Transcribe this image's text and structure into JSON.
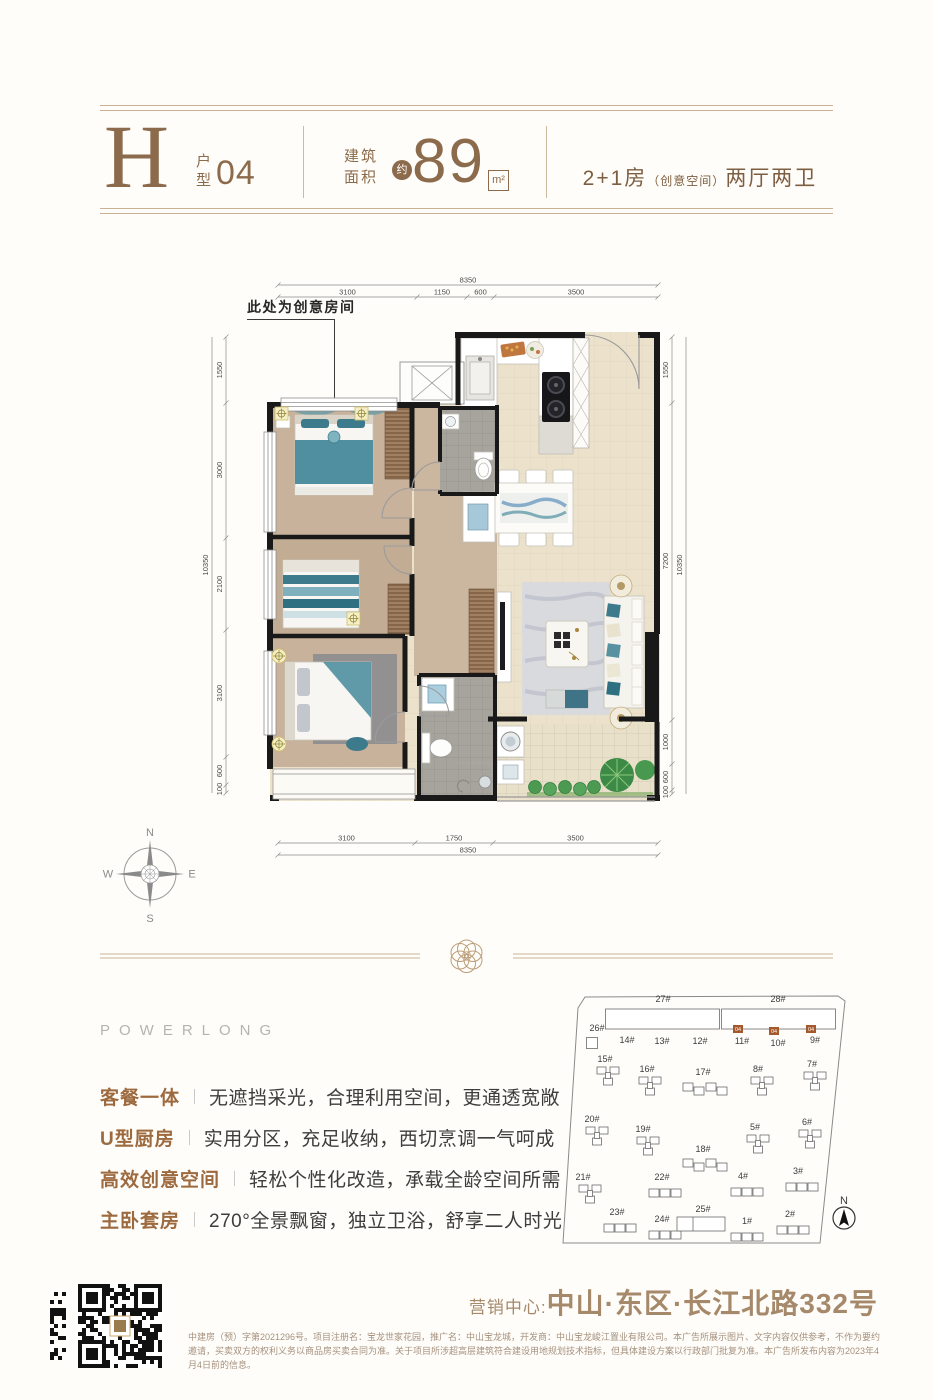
{
  "header": {
    "type_letter": "H",
    "type_stack_top": "户",
    "type_stack_bottom": "型",
    "type_number": "04",
    "area_label_top": "建筑",
    "area_label_bottom": "面积",
    "area_approx": "约",
    "area_value": "89",
    "area_unit": "m²",
    "layout_left": "2+1房",
    "layout_paren": "（创意空间）",
    "layout_right": "两厅两卫"
  },
  "floorplan": {
    "annotation": "此处为创意房间",
    "dims_top": [
      "3100",
      "1150",
      "600",
      "3500"
    ],
    "dims_top_total": "8350",
    "dims_bottom": [
      "3100",
      "1750",
      "3500"
    ],
    "dims_bottom_total": "8350",
    "dims_left": [
      "1550",
      "3000",
      "2100",
      "3100",
      "600",
      "100"
    ],
    "dims_left_total": "10350",
    "dims_right": [
      "1550",
      "7200",
      "1000",
      "600",
      "100"
    ],
    "dims_right_total": "10350",
    "compass": {
      "n": "N",
      "e": "E",
      "s": "S",
      "w": "W"
    }
  },
  "brand": "POWERLONG",
  "features": [
    {
      "label": "客餐一体",
      "desc": "无遮挡采光，合理利用空间，更通透宽敞"
    },
    {
      "label": "U型厨房",
      "desc": "实用分区，充足收纳，西切烹调一气呵成"
    },
    {
      "label": "高效创意空间",
      "desc": "轻松个性化改造，承载全龄空间所需"
    },
    {
      "label": "主卧套房",
      "desc": "270°全景飘窗，独立卫浴，舒享二人时光"
    }
  ],
  "siteplan": {
    "north": "N",
    "highlight_unit": "04",
    "highlights": [
      {
        "x": 188,
        "y": 40
      },
      {
        "x": 224,
        "y": 42
      },
      {
        "x": 261,
        "y": 40
      }
    ],
    "buildings": [
      {
        "label": "27#",
        "t": "bar",
        "lx": 118,
        "ly": 17,
        "gx": 117.5,
        "gy": 34
      },
      {
        "label": "28#",
        "t": "bar",
        "lx": 233,
        "ly": 17,
        "gx": 233.5,
        "gy": 34
      },
      {
        "label": "26#",
        "t": "sq",
        "lx": 52,
        "ly": 46,
        "gx": 47,
        "gy": 58
      },
      {
        "label": "14#",
        "t": "lbl",
        "lx": 82,
        "ly": 58
      },
      {
        "label": "13#",
        "t": "lbl",
        "lx": 117,
        "ly": 59
      },
      {
        "label": "12#",
        "t": "lbl",
        "lx": 155,
        "ly": 59
      },
      {
        "label": "11#",
        "t": "lbl",
        "lx": 197,
        "ly": 59
      },
      {
        "label": "10#",
        "t": "lbl",
        "lx": 233,
        "ly": 61
      },
      {
        "label": "9#",
        "t": "lbl",
        "lx": 270,
        "ly": 58
      },
      {
        "label": "15#",
        "t": "tri",
        "lx": 60,
        "ly": 77,
        "gx": 63,
        "gy": 92
      },
      {
        "label": "16#",
        "t": "tri",
        "lx": 102,
        "ly": 87,
        "gx": 105,
        "gy": 102
      },
      {
        "label": "17#",
        "t": "wide",
        "lx": 158,
        "ly": 90,
        "gx": 160,
        "gy": 104
      },
      {
        "label": "8#",
        "t": "tri",
        "lx": 213,
        "ly": 87,
        "gx": 217,
        "gy": 102
      },
      {
        "label": "7#",
        "t": "tri",
        "lx": 267,
        "ly": 82,
        "gx": 270,
        "gy": 97
      },
      {
        "label": "20#",
        "t": "tri",
        "lx": 47,
        "ly": 137,
        "gx": 52,
        "gy": 152
      },
      {
        "label": "19#",
        "t": "tri",
        "lx": 98,
        "ly": 147,
        "gx": 103,
        "gy": 162
      },
      {
        "label": "18#",
        "t": "wide",
        "lx": 158,
        "ly": 167,
        "gx": 160,
        "gy": 180
      },
      {
        "label": "5#",
        "t": "tri",
        "lx": 210,
        "ly": 145,
        "gx": 213,
        "gy": 160
      },
      {
        "label": "6#",
        "t": "tri",
        "lx": 262,
        "ly": 140,
        "gx": 265,
        "gy": 155
      },
      {
        "label": "21#",
        "t": "tri",
        "lx": 38,
        "ly": 195,
        "gx": 45,
        "gy": 210
      },
      {
        "label": "22#",
        "t": "row",
        "lx": 117,
        "ly": 195,
        "gx": 120,
        "gy": 208
      },
      {
        "label": "4#",
        "t": "row",
        "lx": 198,
        "ly": 194,
        "gx": 202,
        "gy": 207
      },
      {
        "label": "3#",
        "t": "row",
        "lx": 253,
        "ly": 189,
        "gx": 257,
        "gy": 202
      },
      {
        "label": "23#",
        "t": "row",
        "lx": 72,
        "ly": 230,
        "gx": 75,
        "gy": 243
      },
      {
        "label": "24#",
        "t": "row",
        "lx": 117,
        "ly": 237,
        "gx": 120,
        "gy": 250
      },
      {
        "label": "25#",
        "t": "rect",
        "lx": 158,
        "ly": 227,
        "gx": 156,
        "gy": 239
      },
      {
        "label": "1#",
        "t": "row",
        "lx": 202,
        "ly": 239,
        "gx": 202,
        "gy": 252
      },
      {
        "label": "2#",
        "t": "row",
        "lx": 245,
        "ly": 232,
        "gx": 248,
        "gy": 245
      }
    ]
  },
  "footer": {
    "marketing_label": "营销中心:",
    "address": "中山·东区·长江北路332号",
    "disclaimer": "中建房（预）字第2021296号。项目注册名：宝龙世家花园，推广名：中山宝龙城，开发商：中山宝龙峻江置业有限公司。本广告所展示图片、文字内容仅供参考，不作为要约邀请，买卖双方的权利义务以商品房买卖合同为准。关于项目所涉超高层建筑符合建设用地规划技术指标，但具体建设方案以行政部门批复为准。本广告所发布内容为2023年4月4日前的信息。"
  }
}
